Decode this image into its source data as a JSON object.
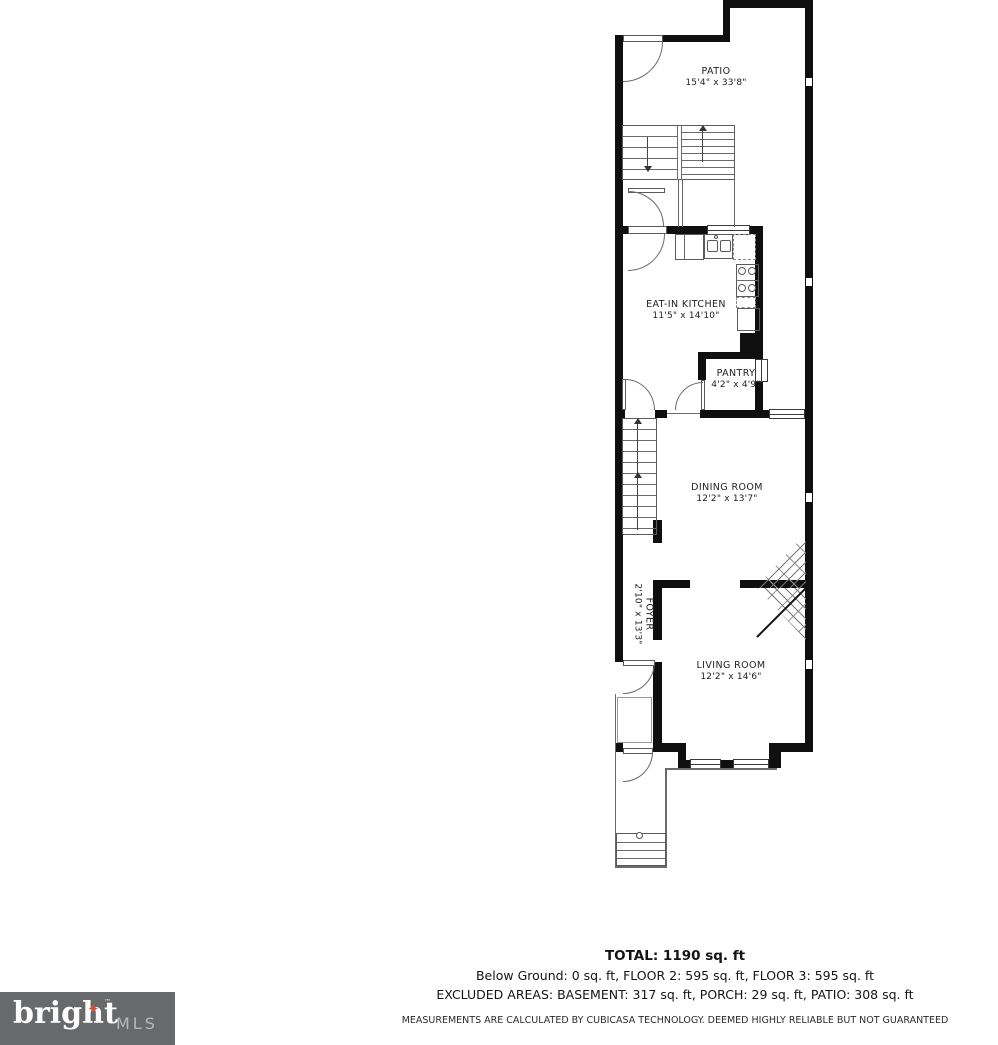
{
  "floorplan": {
    "rooms": [
      {
        "name": "PATIO",
        "dims": "15'4\" x 33'8\""
      },
      {
        "name": "EAT-IN KITCHEN",
        "dims": "11'5\" x 14'10\""
      },
      {
        "name": "PANTRY",
        "dims": "4'2\" x 4'9\""
      },
      {
        "name": "DINING ROOM",
        "dims": "12'2\" x 13'7\""
      },
      {
        "name": "FOYER",
        "dims": "2'10\" x 13'3\""
      },
      {
        "name": "LIVING ROOM",
        "dims": "12'2\" x 14'6\""
      }
    ],
    "footer": {
      "total": "TOTAL: 1190 sq. ft",
      "floors": "Below Ground: 0 sq. ft, FLOOR 2: 595 sq. ft, FLOOR 3: 595 sq. ft",
      "excluded": "EXCLUDED AREAS: BASEMENT: 317 sq. ft, PORCH: 29 sq. ft, PATIO: 308 sq. ft",
      "disclaimer": "MEASUREMENTS ARE CALCULATED BY CUBICASA TECHNOLOGY. DEEMED HIGHLY RELIABLE BUT NOT GUARANTEED"
    },
    "logo": {
      "brand": "bright",
      "tm": "™",
      "star": "✦",
      "suffix": "MLS"
    }
  }
}
